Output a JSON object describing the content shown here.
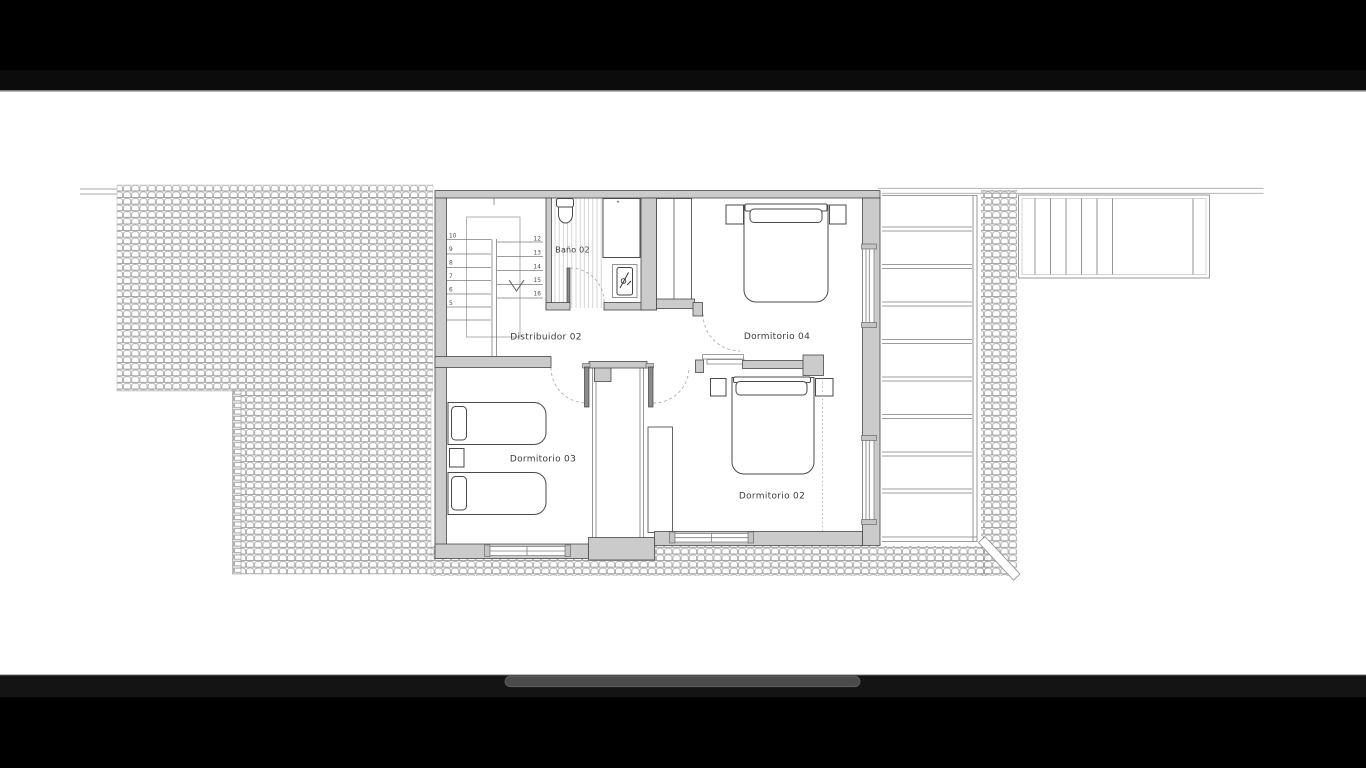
{
  "viewer": {
    "type": "fullscreen-image-viewer",
    "letterbox_color": "#000000",
    "canvas_color": "#ffffff",
    "scrollbar_color": "#4b4b4b"
  },
  "floorplan": {
    "rooms": [
      {
        "name": "bathroom",
        "label": "Baño 02"
      },
      {
        "name": "hallway",
        "label": "Distribuidor 02"
      },
      {
        "name": "bedroom-04",
        "label": "Dormitorio 04"
      },
      {
        "name": "bedroom-03",
        "label": "Dormitorio 03"
      },
      {
        "name": "bedroom-02",
        "label": "Dormitorio 02"
      }
    ],
    "stairs": {
      "left_flight_numbers": [
        "10",
        "9",
        "8",
        "7",
        "6",
        "5"
      ],
      "right_flight_numbers": [
        "12",
        "13",
        "14",
        "15",
        "16"
      ]
    },
    "colors": {
      "wall_fill": "#cbcbcb",
      "line": "#4a4a4a",
      "hatch": "#9e9e9e"
    }
  }
}
